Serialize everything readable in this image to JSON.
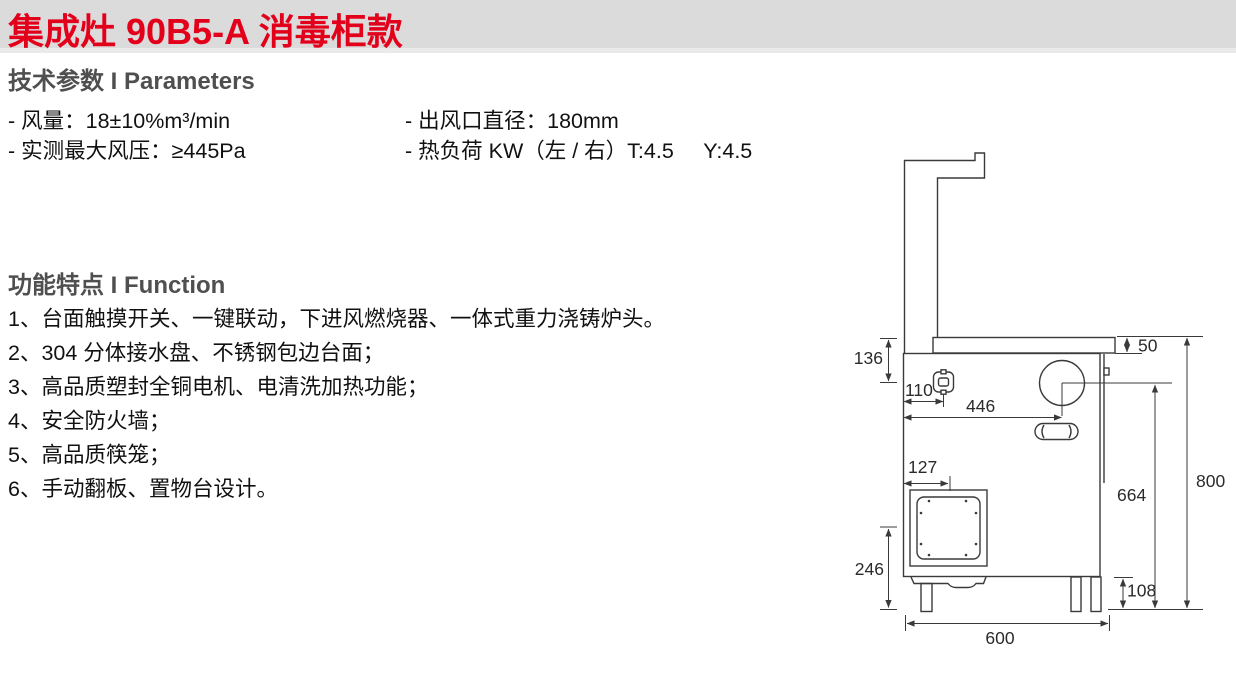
{
  "theme": {
    "title_color": "#e3001b",
    "band_color": "#dbdbdb",
    "heading_color": "#4f4f4f",
    "line_color": "#3a3a3a"
  },
  "header": {
    "title": "集成灶 90B5-A 消毒柜款"
  },
  "parameters": {
    "heading": "技术参数 I Parameters",
    "col1": [
      "- 风量：18±10%m³/min",
      "- 实测最大风压：≥445Pa"
    ],
    "col2": [
      "- 出风口直径：180mm",
      "- 热负荷 KW（左 / 右）T:4.5     Y:4.5"
    ]
  },
  "functions": {
    "heading": "功能特点 I Function",
    "items": [
      "1、台面触摸开关、一键联动，下进风燃烧器、一体式重力浇铸炉头。",
      "2、304 分体接水盘、不锈钢包边台面；",
      "3、高品质塑封全铜电机、电清洗加热功能；",
      "4、安全防火墙；",
      "5、高品质筷笼；",
      "6、手动翻板、置物台设计。"
    ]
  },
  "drawing": {
    "dimensions": {
      "top_to_burner_center": "136",
      "countertop_thickness": "50",
      "valve_offset": "110",
      "burner_center_depth": "446",
      "door_offset": "127",
      "lower_section": "246",
      "burner_to_floor": "664",
      "total_height": "800",
      "leg_height": "108",
      "base_depth": "600"
    }
  }
}
